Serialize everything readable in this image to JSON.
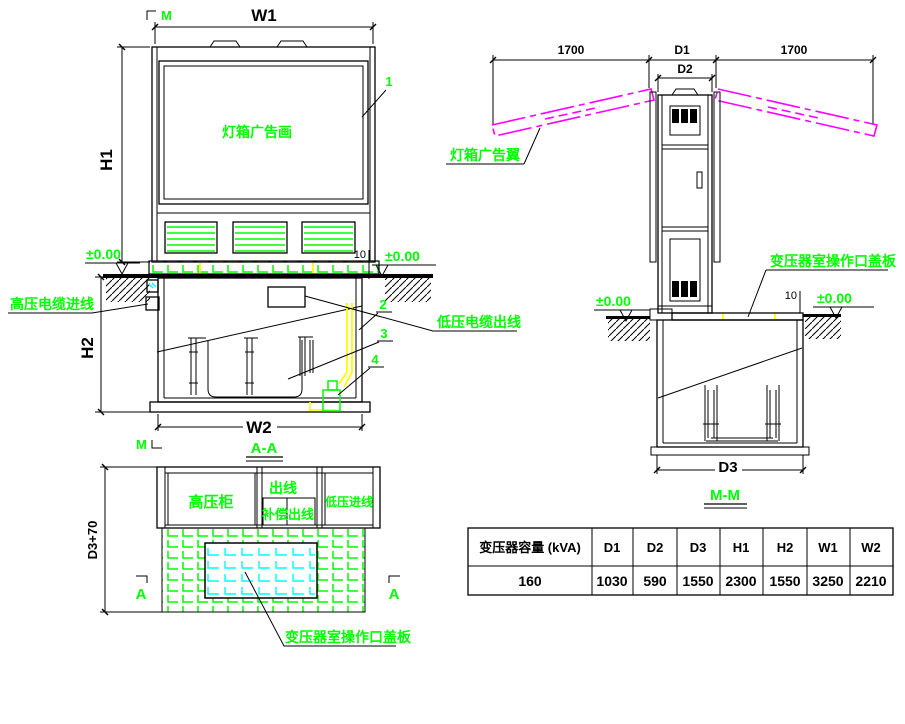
{
  "colors": {
    "line": "#000000",
    "annotation": "#00FF00",
    "wing": "#FF00FF",
    "cable": "#FFFF00",
    "cover_hatch": "#00FFFF",
    "background": "#FFFFFF"
  },
  "front_view": {
    "section_title": "A-A",
    "cut_marker": "M",
    "labels": {
      "lightbox": "灯箱广告画",
      "hv_cable_in": "高压电缆进线",
      "lv_cable_out": "低压电缆出线"
    },
    "balloons": {
      "b1": "1",
      "b2": "2",
      "b3": "3",
      "b4": "4"
    },
    "levels": {
      "left": "±0.00",
      "right": "±0.00"
    },
    "dims": {
      "w1": "W1",
      "h1": "H1",
      "h2": "H2",
      "w2": "W2",
      "plate_thickness": "10"
    }
  },
  "side_view": {
    "section_title": "M-M",
    "labels": {
      "wing": "灯箱广告翼",
      "cover_plate": "变压器室操作口盖板"
    },
    "levels": {
      "left": "±0.00",
      "right": "±0.00"
    },
    "dims": {
      "wing_left": "1700",
      "d1": "D1",
      "d2": "D2",
      "wing_right": "1700",
      "d3": "D3",
      "plate_thickness": "10"
    }
  },
  "plan_view": {
    "cut_marker": "A",
    "dims": {
      "depth": "D3+70"
    },
    "cells": {
      "hv_cabinet": "高压柜",
      "outgoing_top": "出线",
      "compensation": "补偿",
      "outgoing_bottom": "出线",
      "lv_incoming": "低压进线"
    },
    "labels": {
      "cover_plate": "变压器室操作口盖板"
    }
  },
  "spec_table": {
    "headers": [
      "变压器容量 (kVA)",
      "D1",
      "D2",
      "D3",
      "H1",
      "H2",
      "W1",
      "W2"
    ],
    "row": [
      "160",
      "1030",
      "590",
      "1550",
      "2300",
      "1550",
      "3250",
      "2210"
    ]
  }
}
